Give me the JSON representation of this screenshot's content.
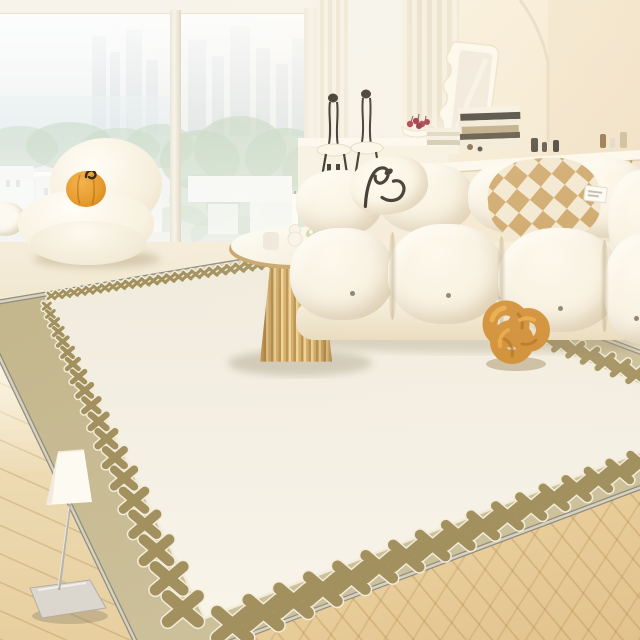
{
  "scene": {
    "description": "Bright cream living room: floor-to-ceiling window with hazy city view, white modular tufted sofa, puffy lounge chair with pumpkin cushion, round gold fluted coffee table, slim floor lamp, and a large cream area rug with a tan border of cross motifs on light oak flooring",
    "objects": [
      {
        "name": "window-city-view",
        "label": "Hazy city skyline, trees and white buildings through floor-to-ceiling window"
      },
      {
        "name": "curtains",
        "label": "Cream pleated sheer curtains"
      },
      {
        "name": "wavy-mirror",
        "label": "White wavy-edge mirror leaning on console"
      },
      {
        "name": "console-desk",
        "label": "White console desk with stacked books and small bottles"
      },
      {
        "name": "bar-stools",
        "label": "Two white stools with black wire backs"
      },
      {
        "name": "fruit-bowl",
        "label": "White bowl with red cherries"
      },
      {
        "name": "puffy-armchair",
        "label": "White puffy lounge chair"
      },
      {
        "name": "pumpkin-pillow",
        "label": "Small orange pumpkin cushion with curled stem"
      },
      {
        "name": "modular-sofa",
        "label": "Cream modular tufted sofa with button details"
      },
      {
        "name": "line-art-pillow",
        "label": "White pillow with black abstract line art"
      },
      {
        "name": "checkered-pillow",
        "label": "Tan and cream checkerboard pillow"
      },
      {
        "name": "knot-pillow",
        "label": "Caramel knot-ball pillow on the rug"
      },
      {
        "name": "coffee-table",
        "label": "Round white-top coffee table with fluted gold base"
      },
      {
        "name": "table-decor",
        "label": "Taper candle, bubble holder, frosted cup and green posy"
      },
      {
        "name": "area-rug",
        "label": "Cream rug, tan border, cross/clover motif row, gray bound edge"
      },
      {
        "name": "floor-lamp",
        "label": "Slim floor lamp, white cone shade, chrome stem, square base"
      },
      {
        "name": "wood-floor",
        "label": "Light oak flooring, herringbone at right"
      }
    ],
    "palette": {
      "wall": "#f4ebd9",
      "window_haze": "#eef0ef",
      "tree": "#bccfba",
      "building": "#f3f5f2",
      "floor_cream": "#efe3cb",
      "wood": "#e8d2a4",
      "rug_band": "#c6ba94",
      "rug_field": "#f5f1e6",
      "rug_x": "#a2905f",
      "rug_line": "#f2ecd9",
      "rug_edge": "#8f8c82",
      "sofa": "#f7f0e0",
      "pillow_check_tan": "#c99f5e",
      "pillow_check_cream": "#f1e6cf",
      "knot": "#cf8a2e",
      "knot_dark": "#a96a15",
      "knot_light": "#eaa93f",
      "pumpkin": "#e69a2d",
      "table_gold": "#c89a55",
      "table_top": "#fcfaf4",
      "lamp_shade": "#fdfaf2",
      "line_art": "#262018"
    }
  }
}
